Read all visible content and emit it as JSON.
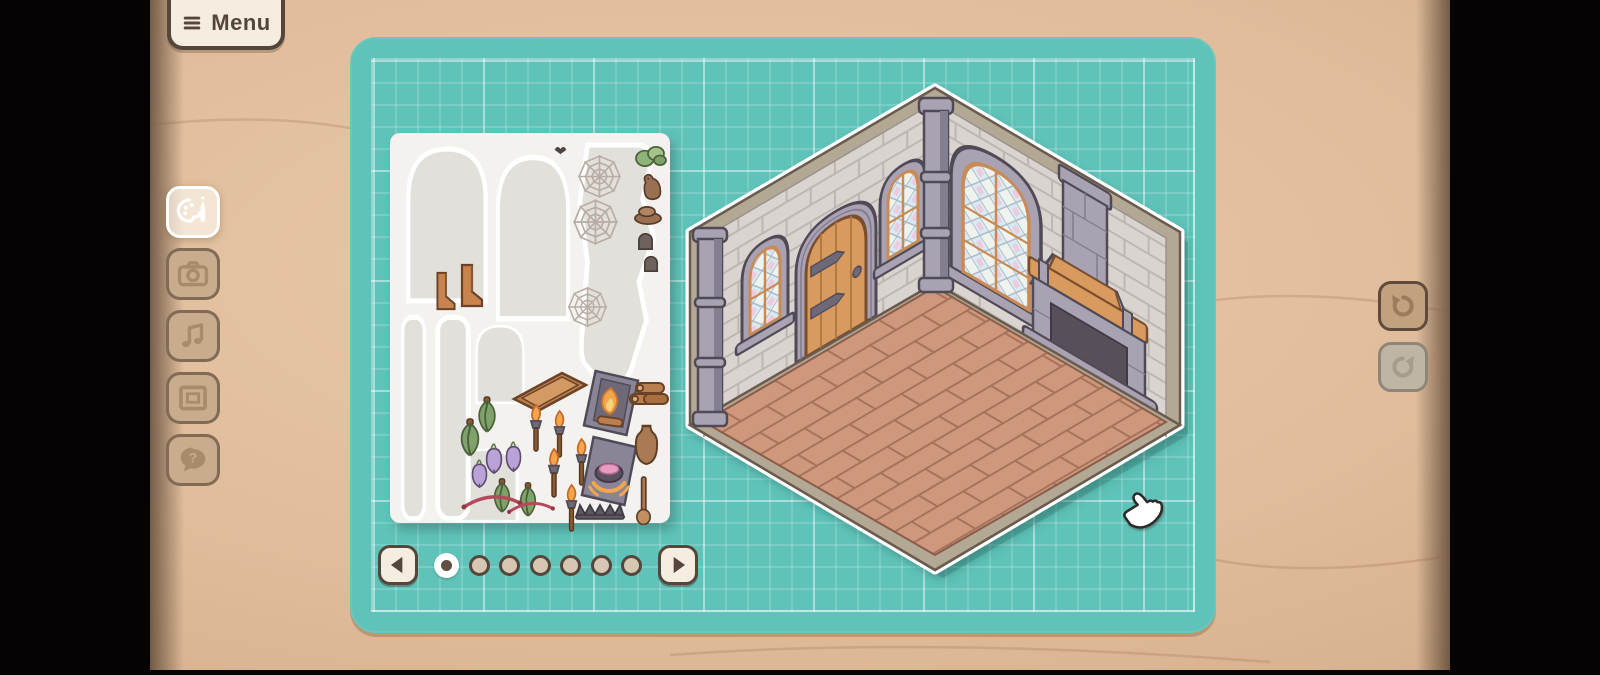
{
  "menu": {
    "label": "Menu",
    "icon": "hamburger-icon"
  },
  "left_toolbar": {
    "items": [
      {
        "id": "palette",
        "icon": "palette-icon",
        "active": true
      },
      {
        "id": "camera",
        "icon": "camera-icon",
        "active": false
      },
      {
        "id": "music",
        "icon": "music-icon",
        "active": false
      },
      {
        "id": "frame",
        "icon": "frame-icon",
        "active": false
      },
      {
        "id": "help",
        "icon": "help-icon",
        "active": false,
        "glyph": "?"
      }
    ]
  },
  "right_toolbar": {
    "items": [
      {
        "id": "undo",
        "icon": "undo-icon",
        "enabled": true
      },
      {
        "id": "redo",
        "icon": "redo-icon",
        "enabled": false
      }
    ]
  },
  "pagination": {
    "current_page": 1,
    "total_pages": 7,
    "prev_icon": "arrow-left-icon",
    "next_icon": "arrow-right-icon"
  },
  "sticker_sheet": {
    "outlines": [
      {
        "name": "window-sticker-outline",
        "shape": "arch",
        "x": 14,
        "y": 10,
        "w": 86,
        "h": 162
      },
      {
        "name": "window-sticker-outline",
        "shape": "arch",
        "x": 104,
        "y": 18,
        "w": 78,
        "h": 172
      },
      {
        "name": "sheet-remnant-outline",
        "shape": "blob",
        "x": 186,
        "y": 8,
        "w": 80,
        "h": 252
      },
      {
        "name": "window-sticker-outline",
        "shape": "arch",
        "x": 84,
        "y": 190,
        "w": 52,
        "h": 82
      },
      {
        "name": "window-sticker-outline",
        "shape": "arch",
        "x": 57,
        "y": 314,
        "w": 74,
        "h": 76
      },
      {
        "name": "column-sticker-outline",
        "shape": "column",
        "x": 10,
        "y": 180,
        "w": 27,
        "h": 210
      },
      {
        "name": "column-sticker-outline",
        "shape": "column",
        "x": 44,
        "y": 180,
        "w": 38,
        "h": 210
      }
    ],
    "stickers": [
      {
        "name": "bat",
        "shape": "bat",
        "x": 163,
        "y": 10,
        "w": 15,
        "h": 12
      },
      {
        "name": "spiderweb",
        "shape": "web",
        "x": 186,
        "y": 20,
        "w": 47,
        "h": 47
      },
      {
        "name": "spiderweb",
        "shape": "web",
        "x": 181,
        "y": 64,
        "w": 49,
        "h": 50
      },
      {
        "name": "spiderweb",
        "shape": "web",
        "x": 176,
        "y": 152,
        "w": 43,
        "h": 44
      },
      {
        "name": "moss-clump",
        "shape": "moss",
        "x": 244,
        "y": 10,
        "w": 34,
        "h": 25
      },
      {
        "name": "rat",
        "shape": "rat",
        "x": 250,
        "y": 40,
        "w": 24,
        "h": 28
      },
      {
        "name": "rock-pile",
        "shape": "rockcap",
        "x": 243,
        "y": 70,
        "w": 30,
        "h": 23
      },
      {
        "name": "stone",
        "shape": "stone",
        "x": 247,
        "y": 97,
        "w": 17,
        "h": 21
      },
      {
        "name": "stone",
        "shape": "stone",
        "x": 253,
        "y": 120,
        "w": 16,
        "h": 20
      },
      {
        "name": "shelf-bracket",
        "shape": "bracket",
        "x": 44,
        "y": 138,
        "w": 24,
        "h": 40
      },
      {
        "name": "shelf-bracket",
        "shape": "bracket",
        "x": 68,
        "y": 130,
        "w": 28,
        "h": 45
      },
      {
        "name": "wooden-tray",
        "shape": "tray",
        "x": 120,
        "y": 236,
        "w": 80,
        "h": 50
      },
      {
        "name": "fireplace-with-fire",
        "shape": "fyre",
        "x": 192,
        "y": 236,
        "w": 58,
        "h": 68
      },
      {
        "name": "log-pile",
        "shape": "logs",
        "x": 238,
        "y": 248,
        "w": 42,
        "h": 30
      },
      {
        "name": "herb-bunch",
        "shape": "herb",
        "x": 82,
        "y": 262,
        "w": 30,
        "h": 40
      },
      {
        "name": "herb-bunch",
        "shape": "herb",
        "x": 64,
        "y": 284,
        "w": 32,
        "h": 42
      },
      {
        "name": "herb-bunch",
        "shape": "herb",
        "x": 98,
        "y": 344,
        "w": 28,
        "h": 38
      },
      {
        "name": "herb-bunch",
        "shape": "herb",
        "x": 124,
        "y": 348,
        "w": 28,
        "h": 38
      },
      {
        "name": "turnip",
        "shape": "turnip",
        "x": 94,
        "y": 310,
        "w": 20,
        "h": 32
      },
      {
        "name": "turnip",
        "shape": "turnip",
        "x": 114,
        "y": 308,
        "w": 19,
        "h": 32
      },
      {
        "name": "turnip",
        "shape": "turnip",
        "x": 80,
        "y": 326,
        "w": 19,
        "h": 30
      },
      {
        "name": "torch",
        "shape": "torch",
        "x": 134,
        "y": 270,
        "w": 24,
        "h": 50
      },
      {
        "name": "torch",
        "shape": "torch",
        "x": 158,
        "y": 276,
        "w": 23,
        "h": 50
      },
      {
        "name": "torch",
        "shape": "torch",
        "x": 180,
        "y": 304,
        "w": 23,
        "h": 50
      },
      {
        "name": "torch",
        "shape": "torch",
        "x": 152,
        "y": 314,
        "w": 24,
        "h": 52
      },
      {
        "name": "torch",
        "shape": "torch",
        "x": 170,
        "y": 350,
        "w": 23,
        "h": 50
      },
      {
        "name": "fireplace-with-cauldron",
        "shape": "cauldron",
        "x": 190,
        "y": 302,
        "w": 58,
        "h": 72
      },
      {
        "name": "jug",
        "shape": "jug",
        "x": 242,
        "y": 290,
        "w": 29,
        "h": 50
      },
      {
        "name": "red-garland",
        "shape": "garland",
        "x": 70,
        "y": 354,
        "w": 64,
        "h": 26
      },
      {
        "name": "red-garland",
        "shape": "garland",
        "x": 116,
        "y": 362,
        "w": 50,
        "h": 22
      },
      {
        "name": "fire-grate",
        "shape": "grate",
        "x": 184,
        "y": 366,
        "w": 52,
        "h": 22
      },
      {
        "name": "wooden-spoon",
        "shape": "spoon",
        "x": 244,
        "y": 342,
        "w": 19,
        "h": 50
      }
    ]
  },
  "room": {
    "elements": [
      "stone-wall-left",
      "stone-wall-right",
      "wood-plank-floor",
      "arched-wood-door",
      "stained-glass-window-small",
      "stained-glass-window-small",
      "stained-glass-window-large",
      "stone-fireplace",
      "stone-pillar-left",
      "stone-pillar-corner"
    ]
  },
  "cursor": {
    "type": "hand-pointer"
  },
  "theme": {
    "colors": {
      "desk": "#e0bd9c",
      "desk_light": "#e8c9a9",
      "desk_deep": "#d0aa86",
      "board": "#5fc3b9",
      "paper": "#f4f2ee",
      "sil": "#e2e0db",
      "cream": "#f5eee0",
      "dark": "#54463a",
      "btn_tan": "#c9ac8e",
      "btn_icon": "#a88b6c",
      "wall": "#dad4d0",
      "mortar": "#bcb5b0",
      "trim": "#b3a893",
      "trimline": "#6a5b4e",
      "floor": "#cf977b",
      "floorline": "#a5715a",
      "stone": "#a8a2b3",
      "stoneline": "#4f4a55",
      "stonedark": "#847e91",
      "wood": "#d89a5e",
      "woodline": "#7a4e2c",
      "red": "#b5485a"
    }
  }
}
